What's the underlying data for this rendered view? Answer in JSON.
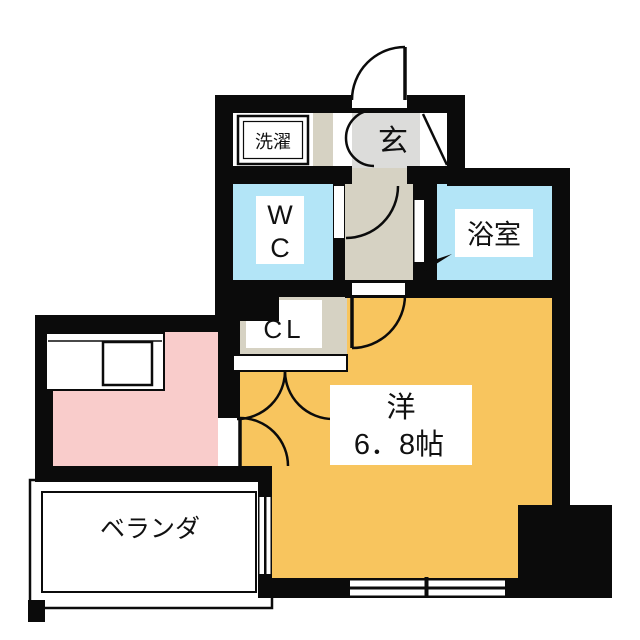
{
  "plan": {
    "rooms": {
      "laundry": {
        "label": "洗濯"
      },
      "entrance": {
        "label": "玄"
      },
      "wc": {
        "line1": "W",
        "line2": "C"
      },
      "bathroom": {
        "label": "浴室"
      },
      "closet": {
        "label": "CL"
      },
      "main_room": {
        "name_label": "洋",
        "size_label": "6．8帖"
      },
      "veranda": {
        "label": "ベランダ"
      }
    },
    "colors": {
      "paper": "#FFFFFF",
      "wall": "#0B0B0B",
      "main_room": "#F8C55E",
      "kitchen": "#F9CCCB",
      "water_rooms": "#B3E5F7",
      "corridor": "#D6D2C3",
      "entrance_floor": "#DCDCDA"
    }
  }
}
